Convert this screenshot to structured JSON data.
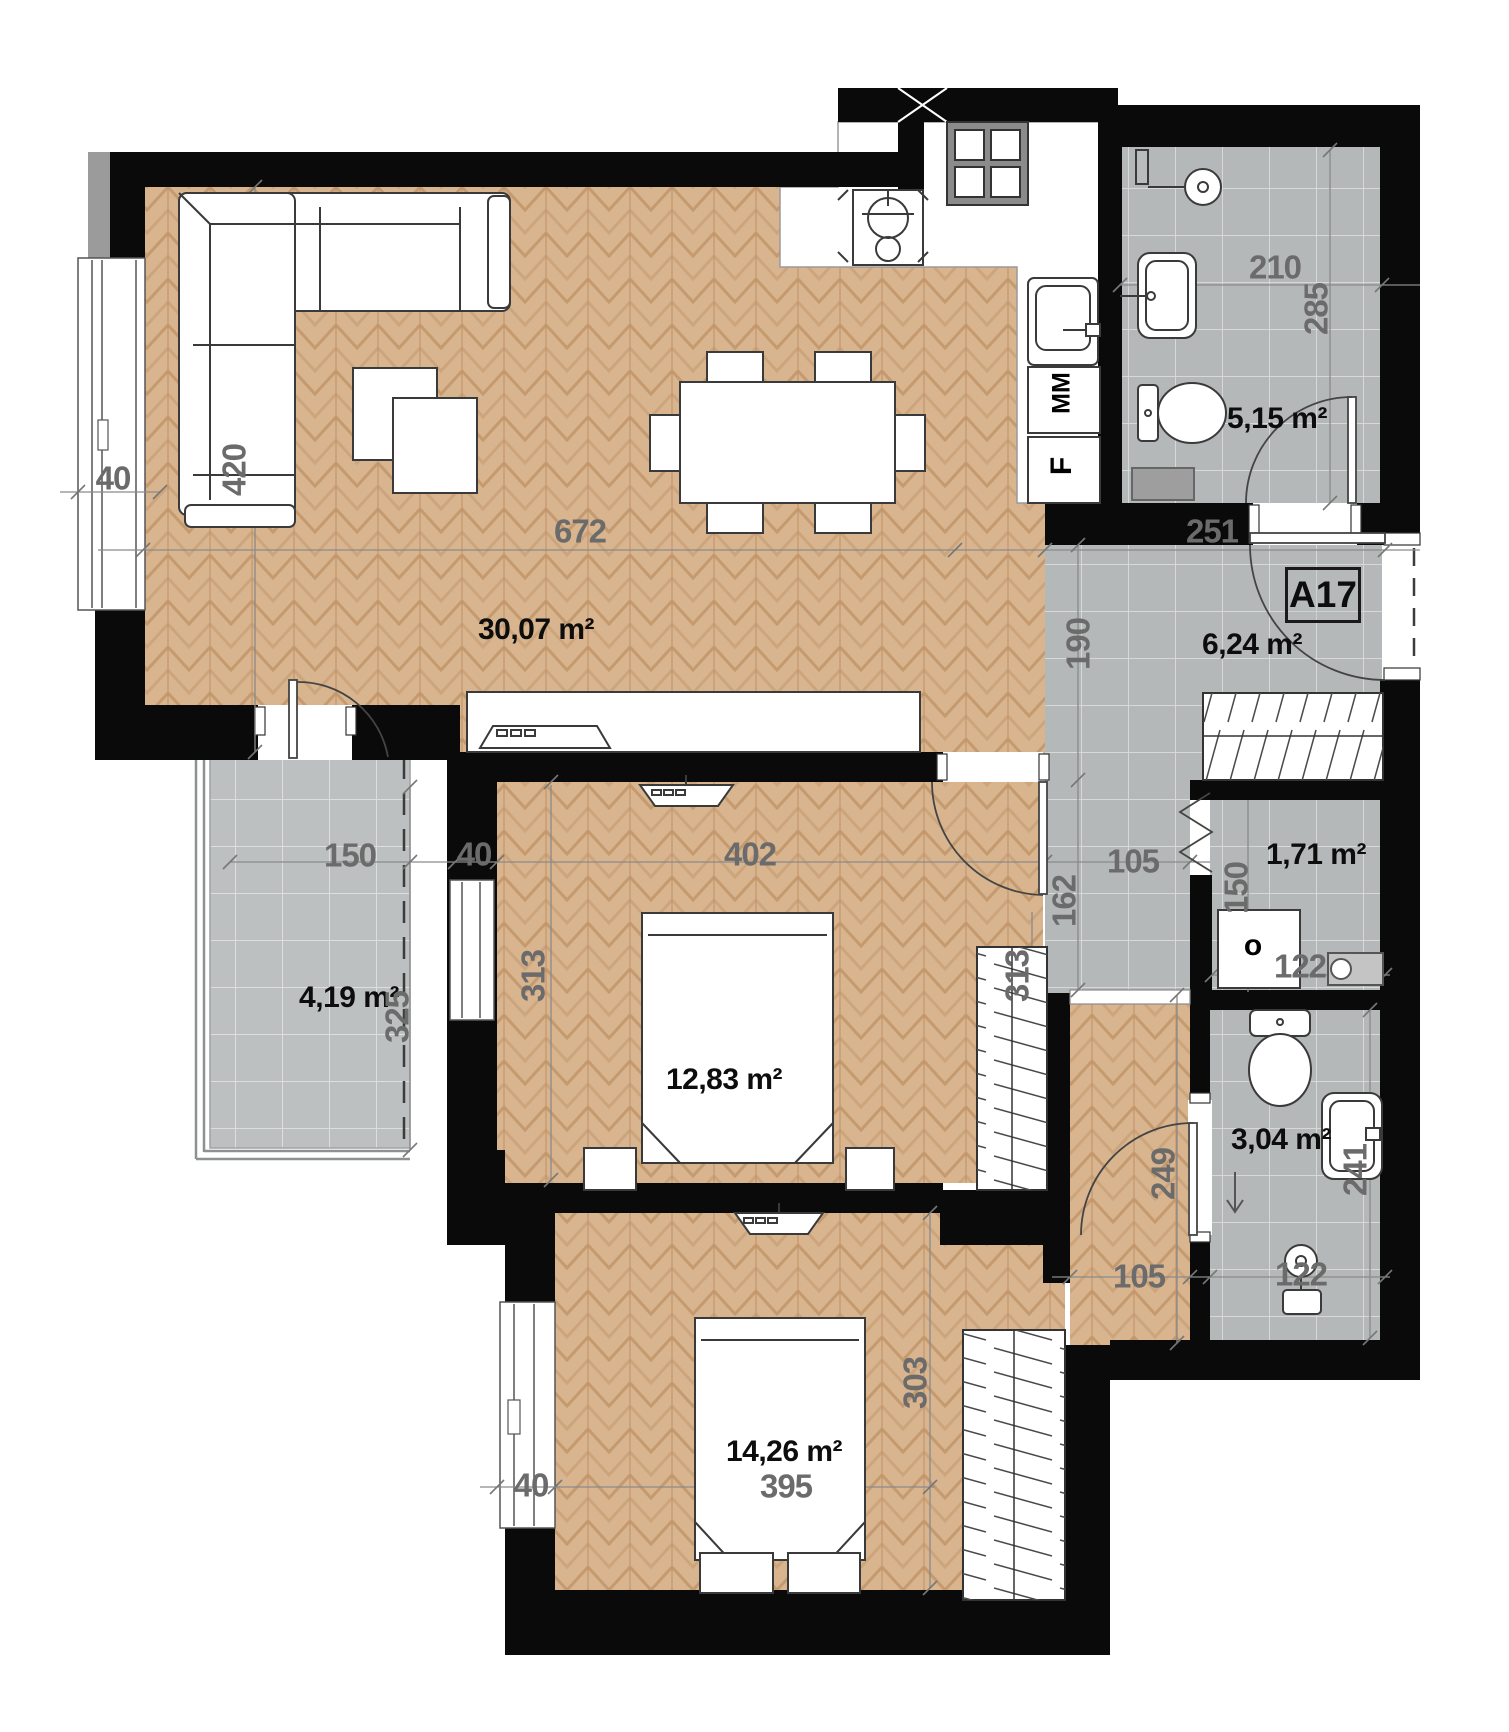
{
  "plan": {
    "unit_label": "A17",
    "washer_column_mark": "MM",
    "fridge_mark": "F",
    "washer_drum_mark": "o"
  },
  "rooms": [
    {
      "id": "living-room-kitchen",
      "area": "30,07 m²"
    },
    {
      "id": "bathroom",
      "area": "5,15 m²"
    },
    {
      "id": "hall",
      "area": "6,24 m²"
    },
    {
      "id": "storage",
      "area": "1,71 m²"
    },
    {
      "id": "balcony",
      "area": "4,19 m²"
    },
    {
      "id": "bedroom-1",
      "area": "12,83 m²"
    },
    {
      "id": "bathroom-2",
      "area": "3,04 m²"
    },
    {
      "id": "bedroom-2",
      "area": "14,26 m²"
    }
  ],
  "dims": [
    {
      "label": "420"
    },
    {
      "label": "40"
    },
    {
      "label": "672"
    },
    {
      "label": "210"
    },
    {
      "label": "285"
    },
    {
      "label": "251"
    },
    {
      "label": "190"
    },
    {
      "label": "150"
    },
    {
      "label": "40"
    },
    {
      "label": "402"
    },
    {
      "label": "105"
    },
    {
      "label": "162"
    },
    {
      "label": "150"
    },
    {
      "label": "122"
    },
    {
      "label": "325"
    },
    {
      "label": "313"
    },
    {
      "label": "313"
    },
    {
      "label": "249"
    },
    {
      "label": "241"
    },
    {
      "label": "105"
    },
    {
      "label": "122"
    },
    {
      "label": "395"
    },
    {
      "label": "303"
    },
    {
      "label": "40"
    }
  ],
  "colors": {
    "wall": "#0a0a0a",
    "wood": "#d8b58e",
    "wood_line": "#c59a6f",
    "tile": "#b5b8b9",
    "tile_balcony": "#bdc0c0",
    "grout": "#d7d9d9",
    "dim_text": "#6b6b6b",
    "area_text": "#0d0d0d",
    "fixture_stroke": "#3a3a3a"
  }
}
